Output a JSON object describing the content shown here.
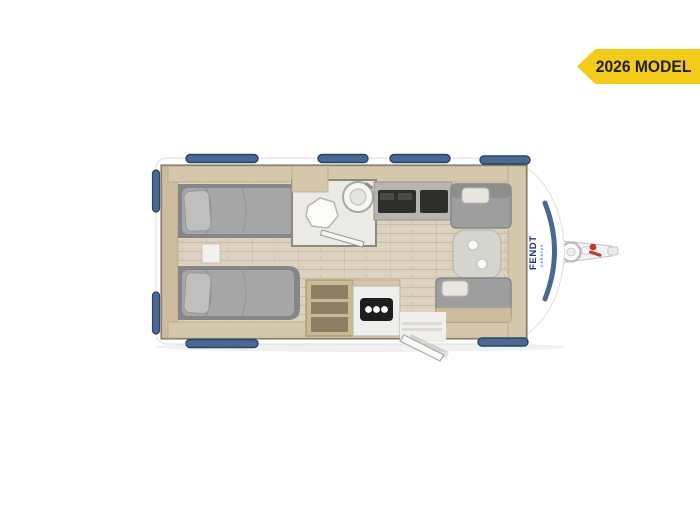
{
  "badge": {
    "label": "2026 MODEL",
    "bg_color": "#F3CC17",
    "text_color": "#20202A"
  },
  "brand": {
    "name": "FENDT",
    "sub": "CARAVAN",
    "color": "#1C3A6B"
  },
  "colors": {
    "window_blue": "#4A6890",
    "window_blue_dark": "#27456A",
    "body_white": "#FFFFFF",
    "wall_dark": "#6E675C",
    "floor_wood": "#DCD1BE",
    "floor_wood_line": "#C9BCA5",
    "furniture_wood": "#D4C7AC",
    "furniture_wood_dark": "#B9A987",
    "upholstery_gray": "#A6A6A6",
    "bed_frame_gray": "#85858A",
    "bathroom_floor": "#ECEAE6",
    "table_gray": "#D5D5D0",
    "counter_dark": "#2E2E2C",
    "jockey_wheel_red": "#C23B2E"
  },
  "floorplan": {
    "type": "caravan top-down floorplan",
    "hob_burners": 3,
    "features": [
      "twin-bed-top",
      "twin-bed-bottom",
      "bedside-step",
      "wardrobe",
      "toilet",
      "corner-washbasin",
      "bathroom-door",
      "kitchen-counter",
      "kitchen-shelf-unit",
      "kitchen-hob",
      "dinette-table",
      "dinette-bench-front",
      "dinette-bench-rear",
      "entry-door",
      "entry-step",
      "hitch-drawbar",
      "jockey-wheel"
    ],
    "windows": {
      "top": 4,
      "bottom": 2,
      "rear_side": 2
    }
  }
}
